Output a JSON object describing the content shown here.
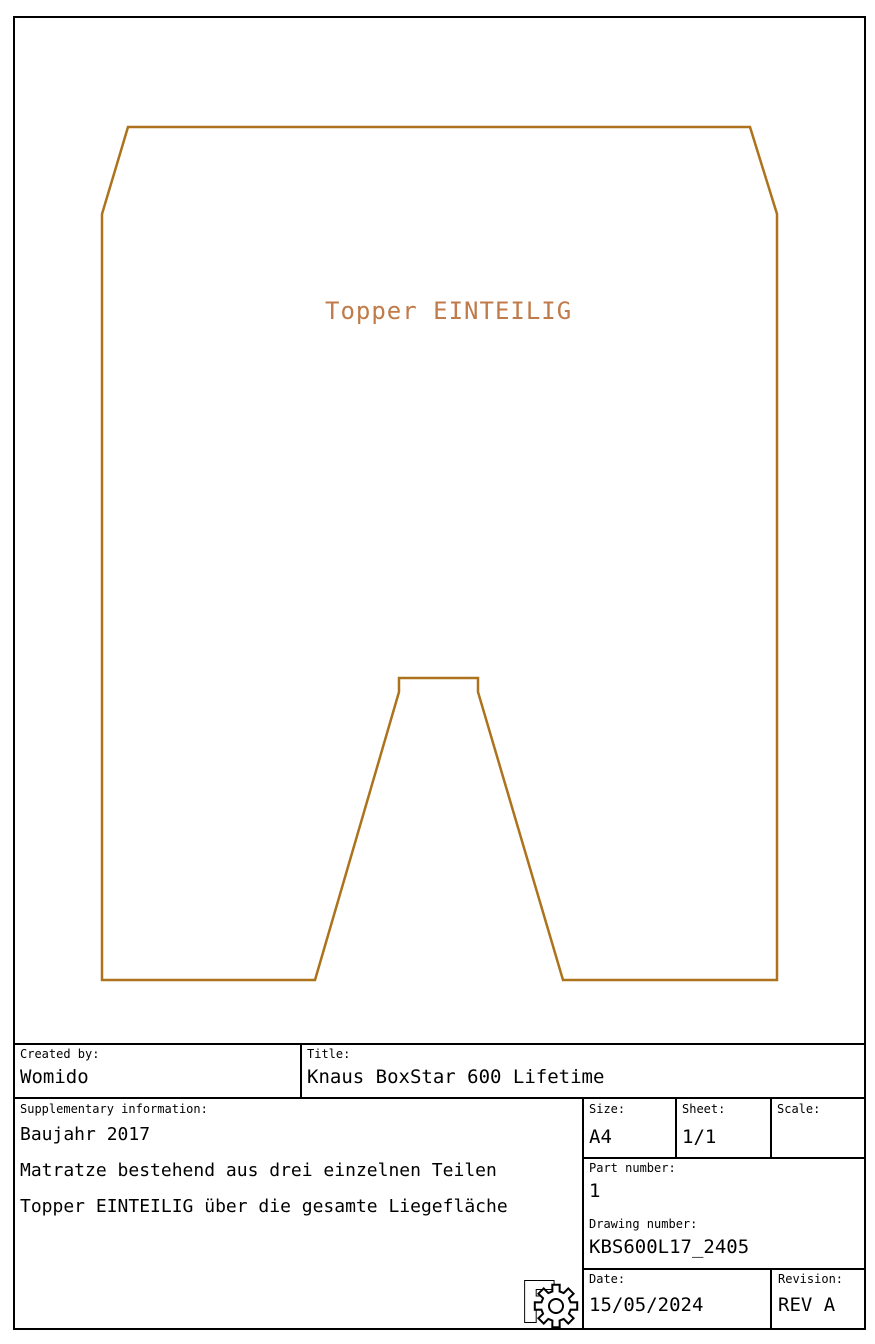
{
  "drawing": {
    "label": "Topper EINTEILIG",
    "label_color": "#c07b4a",
    "outline_color": "#ac721c",
    "outline_points": "128,127 750,127 777,214 777,980 563,980 478,692 478,678 399,678 399,692 315,980 102,980 102,214"
  },
  "title_block": {
    "created_by": {
      "label": "Created by:",
      "value": "Womido"
    },
    "title": {
      "label": "Title:",
      "value": "Knaus BoxStar 600 Lifetime"
    },
    "supplementary": {
      "label": "Supplementary information:",
      "lines": [
        "Baujahr 2017",
        "Matratze bestehend aus drei einzelnen Teilen",
        "Topper EINTEILIG über die gesamte Liegefläche"
      ]
    },
    "size": {
      "label": "Size:",
      "value": "A4"
    },
    "sheet": {
      "label": "Sheet:",
      "value": "1/1"
    },
    "scale": {
      "label": "Scale:",
      "value": ""
    },
    "part_number": {
      "label": "Part number:",
      "value": "1"
    },
    "drawing_number": {
      "label": "Drawing number:",
      "value": "KBS600L17_2405"
    },
    "date": {
      "label": "Date:",
      "value": "15/05/2024"
    },
    "revision": {
      "label": "Revision:",
      "value": "REV A"
    }
  },
  "logo": {
    "letter": "F"
  }
}
